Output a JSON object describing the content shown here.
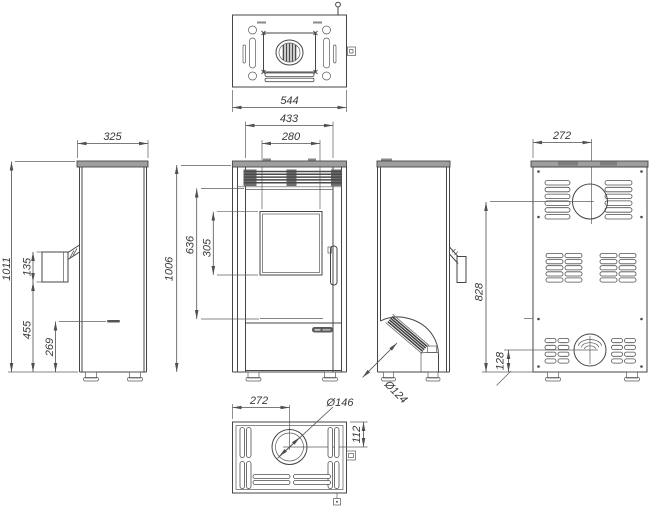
{
  "drawing": {
    "type": "technical-dimension-drawing",
    "subject": "free-standing stove, five orthographic views",
    "unit": "mm",
    "line_color": "#454545",
    "dims": {
      "top_width": "544",
      "front_face_width": "433",
      "glass_width": "280",
      "side_depth": "325",
      "total_height": "1011",
      "handle_length": "135",
      "handle_bottom_height": "455",
      "lever_height": "269",
      "body_height": "1006",
      "front_mid_height": "636",
      "glass_height": "305",
      "rear_flue_diameter": "Ø124",
      "back_flue_offset": "272",
      "flue_center_height": "828",
      "intake_center_height": "128",
      "bottom_flue_offset": "272",
      "bottom_flue_diameter": "Ø146",
      "bottom_flue_depth_offset": "112"
    }
  }
}
